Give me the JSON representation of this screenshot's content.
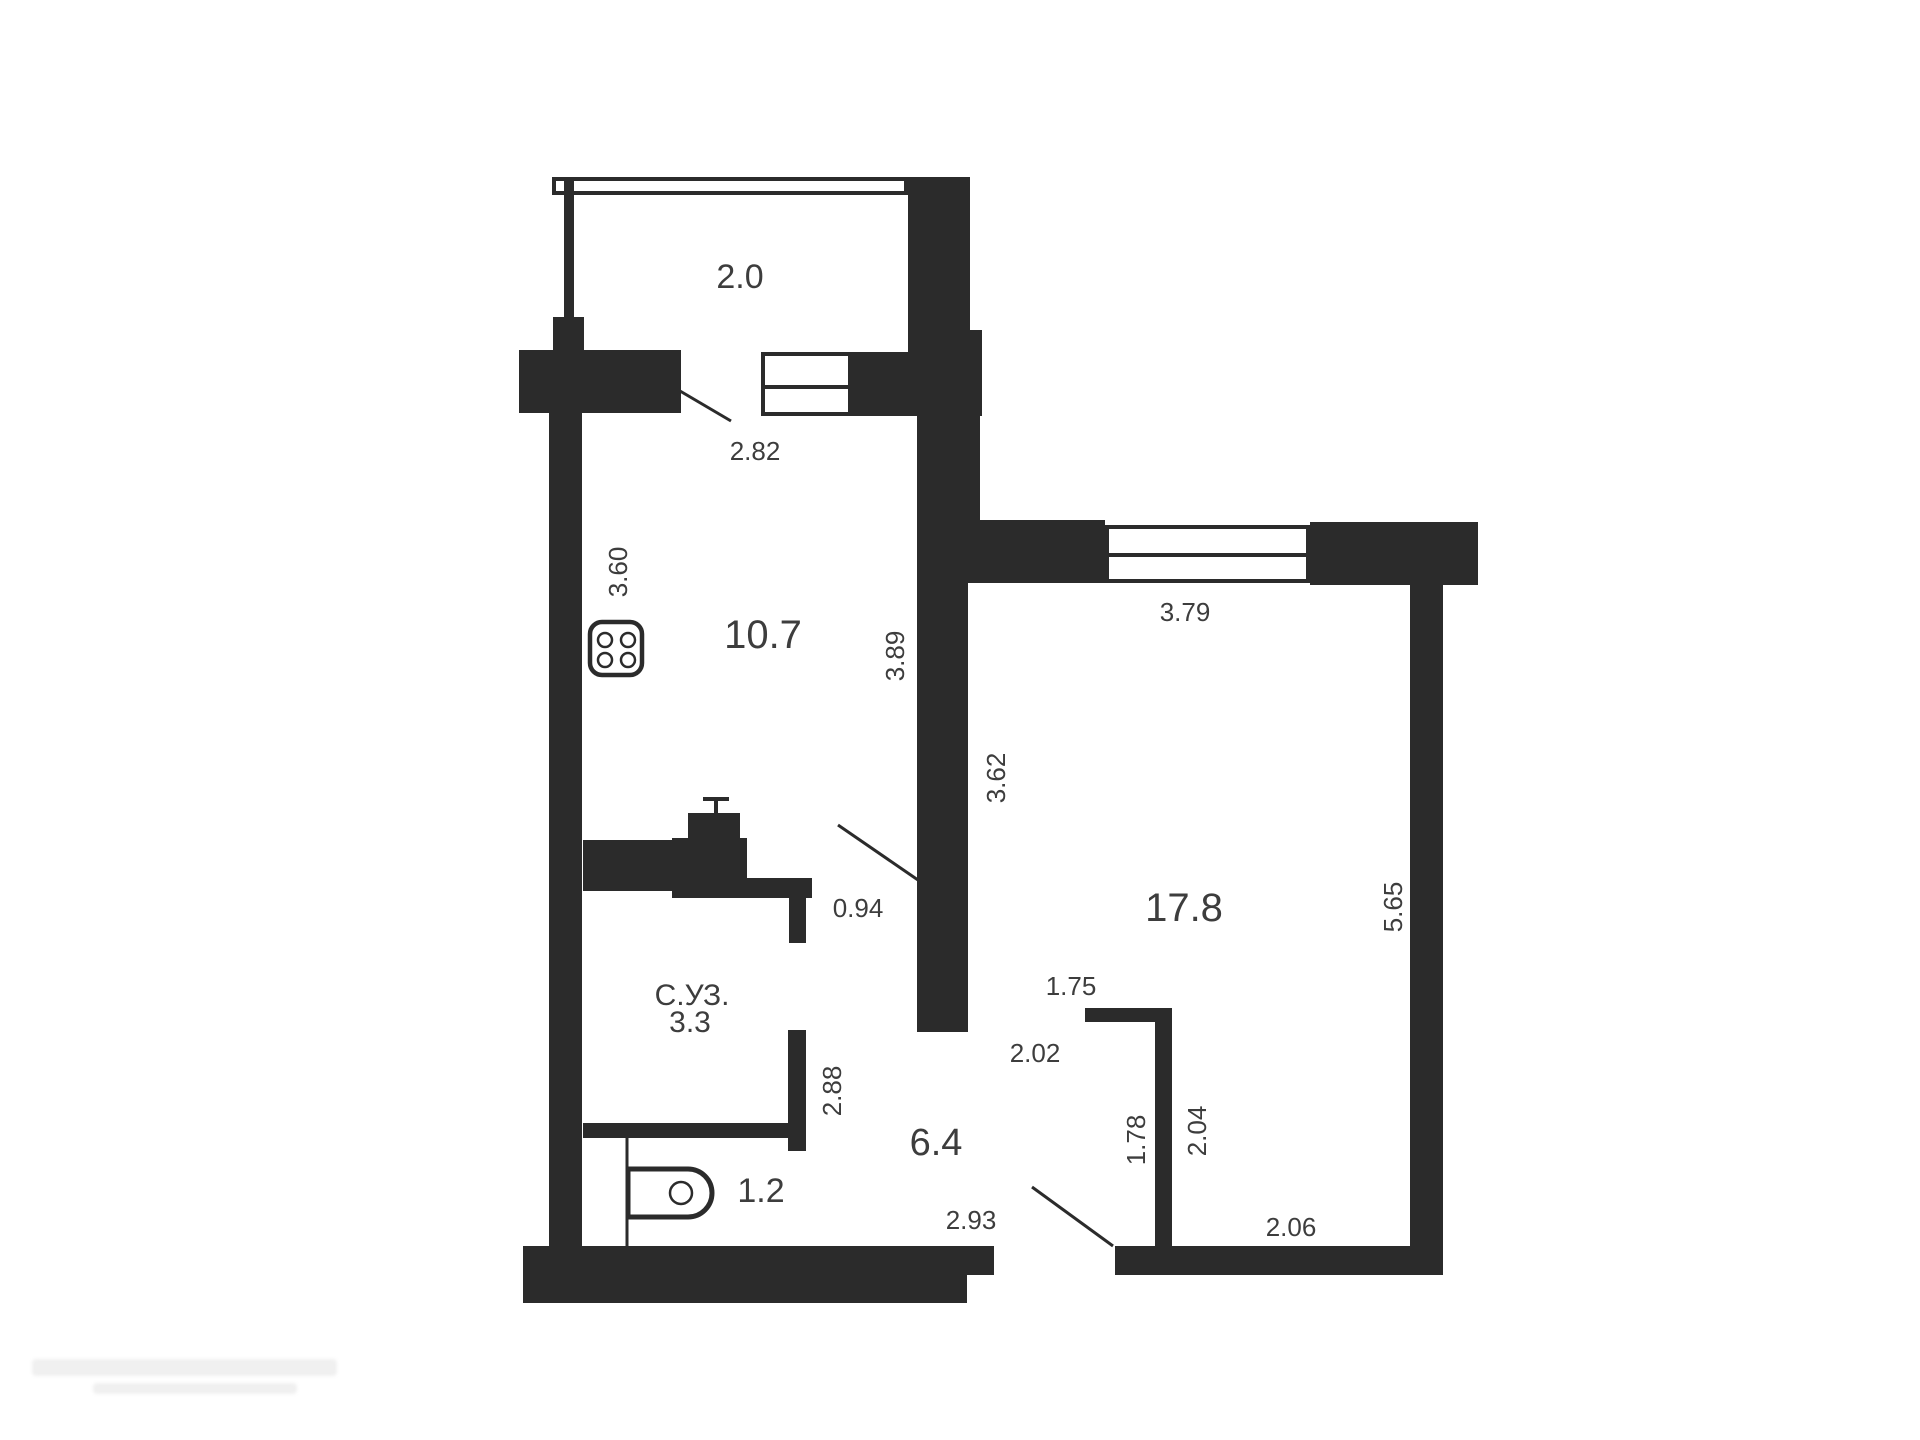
{
  "document": {
    "type": "apartment-floor-plan"
  },
  "colors": {
    "wall": "#2b2b2b",
    "text": "#3d3d3d",
    "background": "#ffffff"
  },
  "labels": {
    "balcony_area": {
      "text": "2.0"
    },
    "balcony_door_dim": {
      "text": "2.82"
    },
    "kitchen_depth_dim": {
      "text": "3.60"
    },
    "kitchen_area": {
      "text": "10.7"
    },
    "kitchen_wall_dim": {
      "text": "3.89"
    },
    "room_window_dim": {
      "text": "3.79"
    },
    "room_upper_dim": {
      "text": "3.62"
    },
    "room_area": {
      "text": "17.8"
    },
    "room_right_dim": {
      "text": "5.65"
    },
    "kitchen_door_dim": {
      "text": "0.94"
    },
    "wc_name": {
      "text": "С.УЗ."
    },
    "wc_area": {
      "text": "3.3"
    },
    "wc_height_dim": {
      "text": "2.88"
    },
    "hall_area": {
      "text": "6.4"
    },
    "hall_top_dim": {
      "text": "2.02"
    },
    "niche_top_dim": {
      "text": "1.75"
    },
    "niche_left_dim": {
      "text": "1.78"
    },
    "niche_right_dim": {
      "text": "2.04"
    },
    "toilet_area": {
      "text": "1.2"
    },
    "hall_bottom_dim": {
      "text": "2.93"
    },
    "room_bottom_dim": {
      "text": "2.06"
    }
  },
  "icons": [
    "stove-icon",
    "toilet-icon",
    "pipe-riser-icon"
  ]
}
